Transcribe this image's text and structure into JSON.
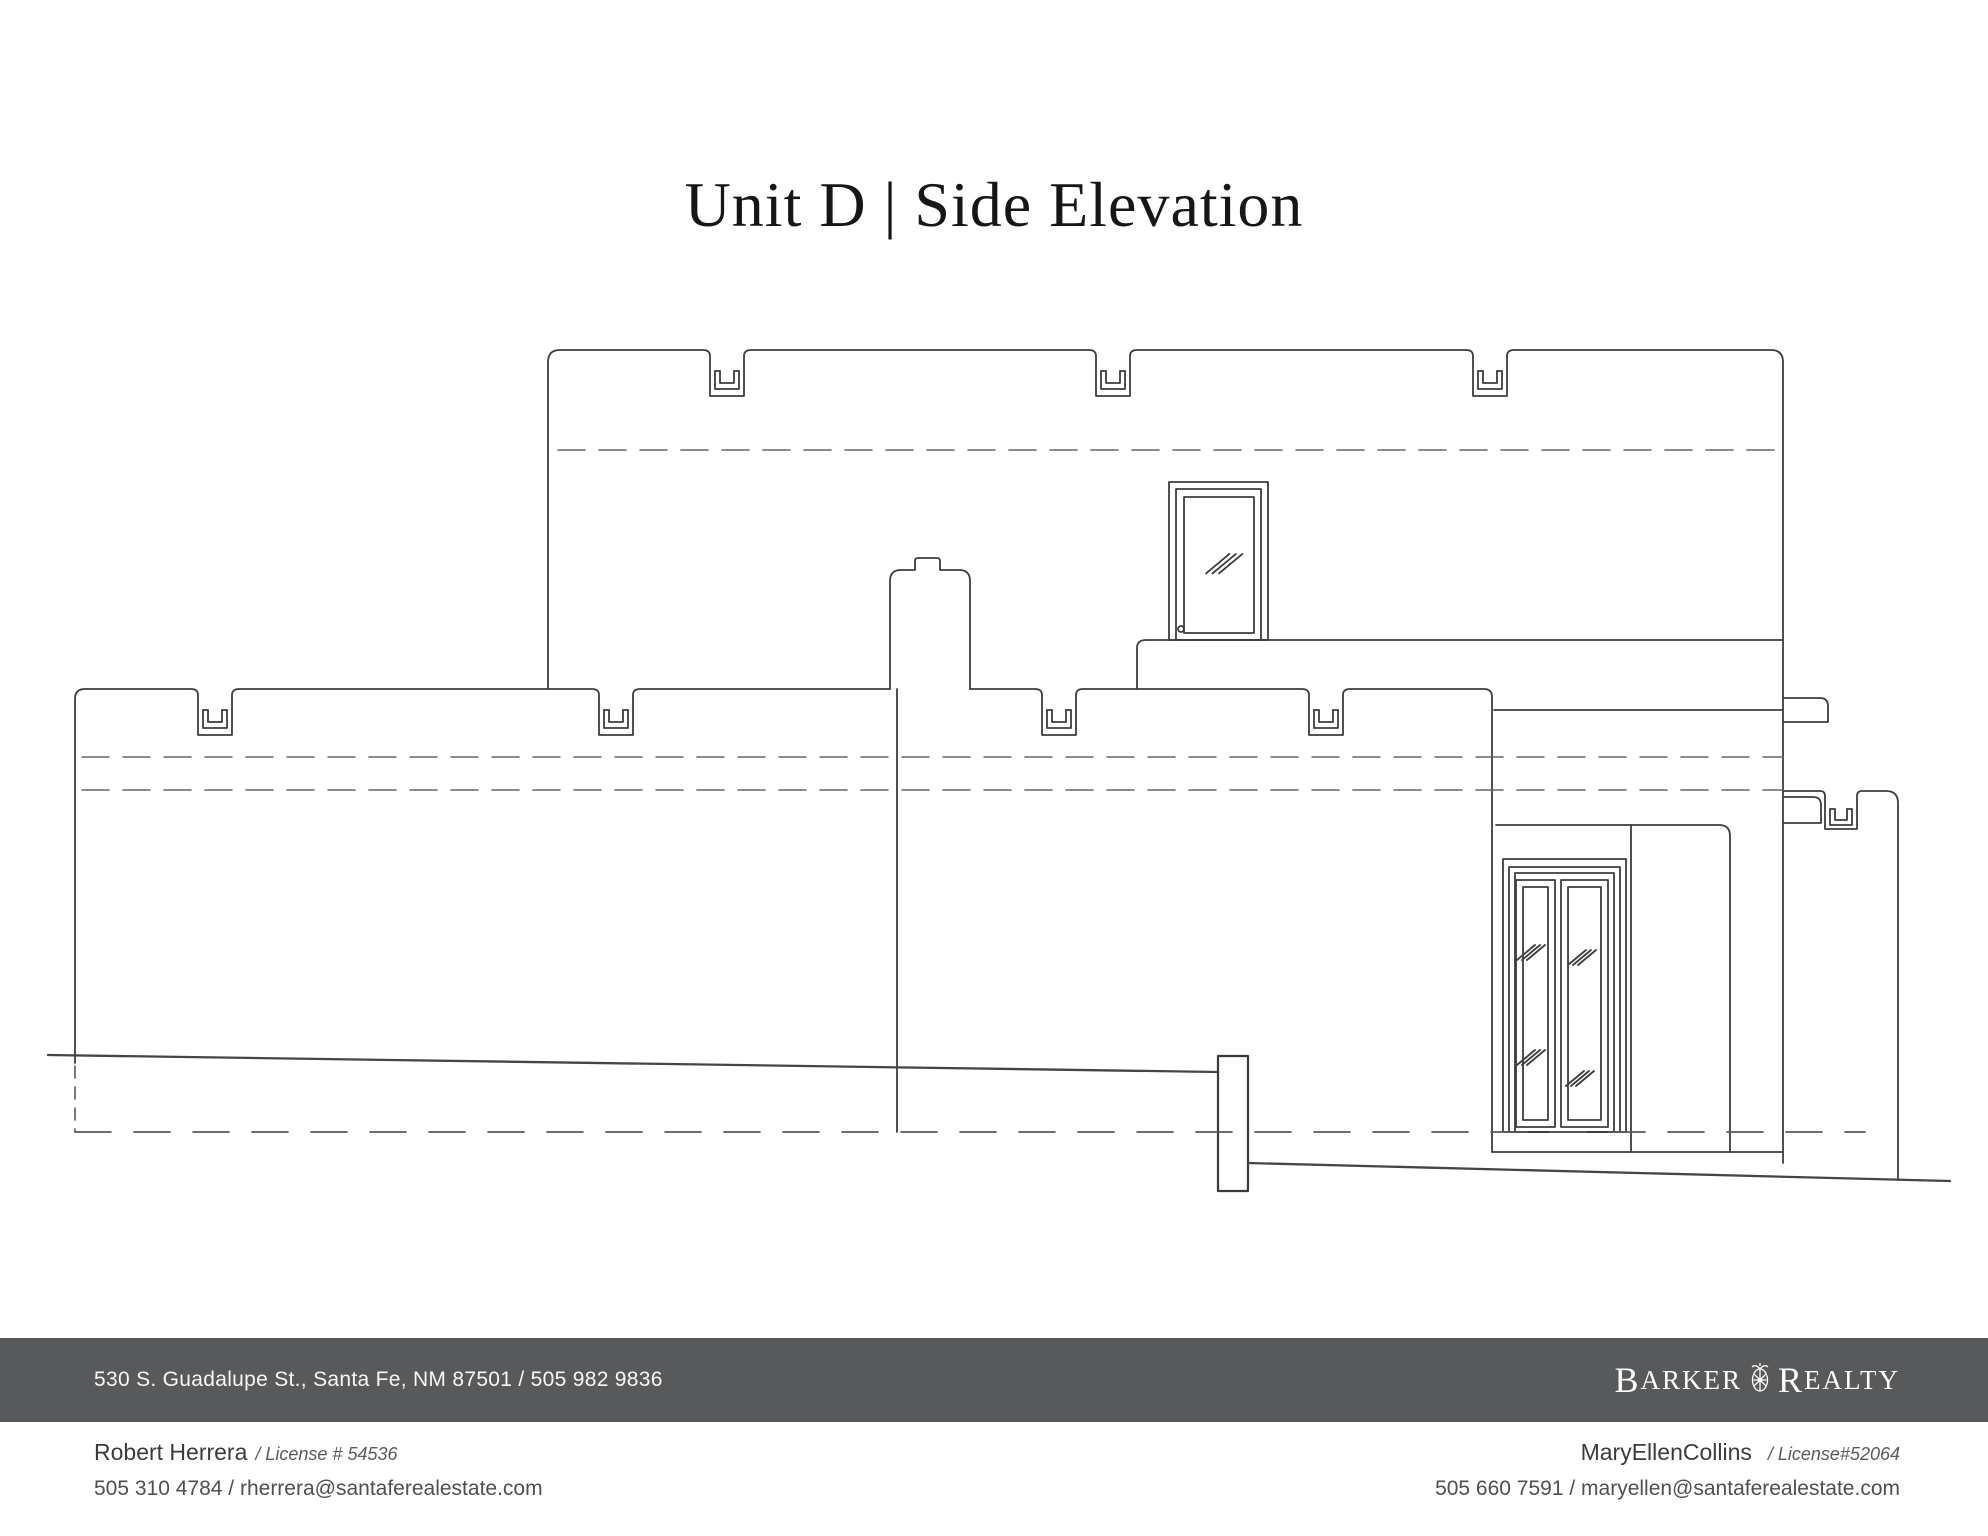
{
  "title": "Unit D | Side Elevation",
  "colors": {
    "bar": "#58595a",
    "line": "#3d3d3d",
    "dash": "#666666",
    "bar_text": "#f7f7f7",
    "text_dark": "#3b3b3b",
    "text_mid": "#4f4f4f"
  },
  "footer": {
    "address": "530 S. Guadalupe St., Santa Fe, NM 87501 / 505 982 9836",
    "brand": {
      "word1_initial": "B",
      "word1_rest": "ARKER",
      "word2_initial": "R",
      "word2_rest": "EALTY",
      "crest_icon": "barker-realty-crest-icon"
    }
  },
  "agents": {
    "left": {
      "name": "Robert Herrera",
      "license": "/ License # 54536",
      "contact": "505 310 4784 / rherrera@santaferealestate.com"
    },
    "right": {
      "name": "MaryEllenCollins",
      "license": "/ License#52064",
      "contact": "505 660 7591 / maryellen@santaferealestate.com"
    }
  },
  "drawing": {
    "description": "side elevation line drawing of adobe-style unit with parapet canales",
    "upper_parapet": {
      "left": 548,
      "top": 350,
      "right": 1783,
      "left_bottom": 689,
      "right_bottom": 1163,
      "canales": [
        727,
        1113,
        1490
      ]
    },
    "lower_parapet": {
      "top": 689,
      "seg_a": {
        "left": 75,
        "left_edge_bottom": 1063,
        "end": 890,
        "canales": [
          215,
          616
        ]
      },
      "seg_b": {
        "start": 970,
        "corner": 1492,
        "drop_to": 1152,
        "canales": [
          1059,
          1326
        ]
      }
    },
    "glass_hatches": [
      {
        "x": 1219,
        "y": 563,
        "s": 1.3
      },
      {
        "x": 1527,
        "y": 952,
        "s": 1.0
      },
      {
        "x": 1527,
        "y": 1057,
        "s": 1.0
      },
      {
        "x": 1578,
        "y": 957,
        "s": 1.0
      },
      {
        "x": 1576,
        "y": 1078,
        "s": 1.0
      }
    ]
  }
}
